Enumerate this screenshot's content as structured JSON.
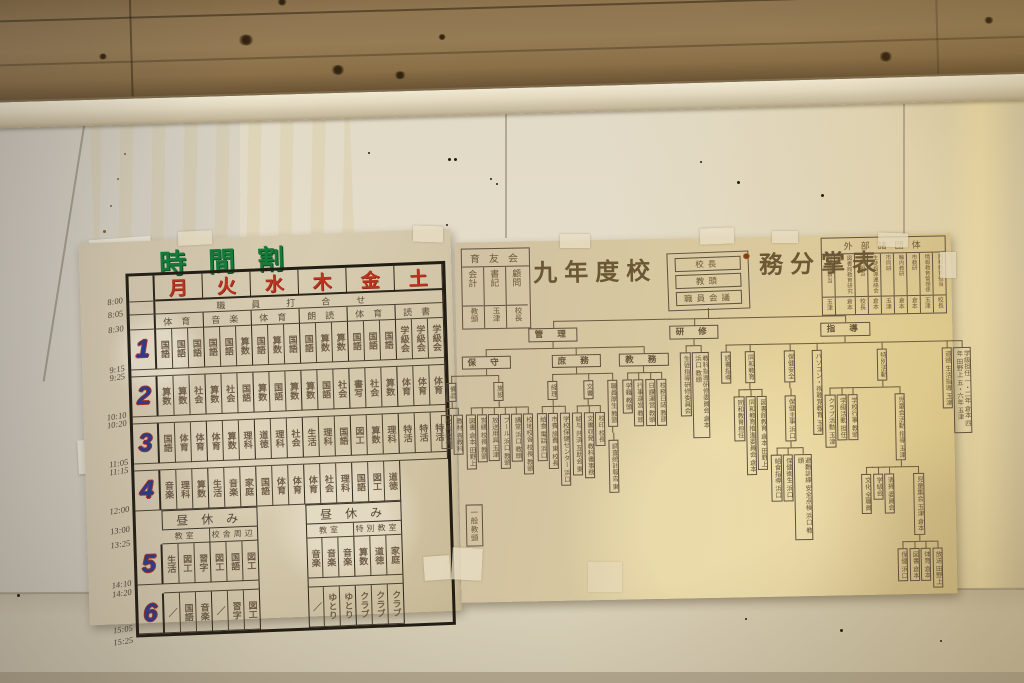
{
  "colors": {
    "title_green": "#157a3a",
    "day_red": "#b8341f",
    "period_blue": "#2b3a8f",
    "ink_brown": "#6b5838",
    "paper_left": "#d2c5a6",
    "paper_right": "#d8c89f",
    "wall_cream": "#e0d9c6",
    "wood_brown": "#8a6f48"
  },
  "timetable": {
    "title": "時間割",
    "days": [
      "月",
      "火",
      "水",
      "木",
      "金",
      "土"
    ],
    "staff_meeting": "職員打合せ",
    "morning_activities": [
      "体育",
      "音楽",
      "体育",
      "朗読",
      "体育",
      "読書"
    ],
    "period_labels": [
      "1",
      "2",
      "3",
      "4",
      "5",
      "6"
    ],
    "times": [
      "8:00",
      "8:05",
      "8:30",
      "9:15",
      "9:25",
      "10:10",
      "10:20",
      "11:05",
      "11:15",
      "12:00",
      "13:00",
      "13:25",
      "14:10",
      "14:20",
      "15:05",
      "15:25"
    ],
    "lunch": "昼休み",
    "locations": [
      "教室",
      "校舎周辺",
      "教室",
      "特別教室"
    ],
    "periods": [
      [
        "国語",
        "国語",
        "国語",
        "国語",
        "国語",
        "算数",
        "国語",
        "算数",
        "国語",
        "国語",
        "算数",
        "算数",
        "国語",
        "国語",
        "国語",
        "学級会",
        "学級会",
        "学級会"
      ],
      [
        "算数",
        "算数",
        "社会",
        "算数",
        "社会",
        "国語",
        "算数",
        "国語",
        "算数",
        "算数",
        "国語",
        "社会",
        "書写",
        "社会",
        "算数",
        "体育",
        "体育",
        "体育"
      ],
      [
        "国語",
        "体育",
        "体育",
        "体育",
        "算数",
        "理科",
        "道徳",
        "理科",
        "社会",
        "生活",
        "理科",
        "国語",
        "図工",
        "算数",
        "理科",
        "特活",
        "特活",
        "特活"
      ],
      [
        "音楽",
        "理科",
        "算数",
        "生活",
        "音楽",
        "家庭",
        "国語",
        "体育",
        "体育",
        "体育",
        "社会",
        "理科",
        "国語",
        "図工",
        "道徳",
        null,
        null,
        null
      ],
      [
        "生活",
        "図工",
        "習字",
        "図工",
        "国語",
        "図工",
        null,
        null,
        null,
        "音楽",
        "音楽",
        "音楽",
        "算数",
        "道徳",
        "家庭",
        null,
        null,
        null
      ],
      [
        "／",
        "国語",
        "音楽",
        "／",
        "習字",
        "図工",
        null,
        null,
        null,
        "／",
        "ゆとり",
        "ゆとり",
        "クラブ",
        "クラブ",
        "クラブ",
        null,
        null,
        null
      ]
    ]
  },
  "orgchart": {
    "title_left": "九年度校",
    "title_right": "務分掌表",
    "root": [
      "校長",
      "教頭",
      "職員会議"
    ],
    "general_staff": "一般教頭",
    "pta": {
      "header": "育友会",
      "cols": [
        {
          "role": "会計",
          "name": "教頭"
        },
        {
          "role": "書記",
          "name": "玉津"
        },
        {
          "role": "顧問",
          "name": "校長"
        }
      ]
    },
    "external": {
      "header": "外部諸団体",
      "cols": [
        {
          "role": "児童会担当",
          "name": "玉津"
        },
        {
          "role": "図書館教育研究会",
          "name": "倉本"
        },
        {
          "role": "ALT担当",
          "name": "校長"
        },
        {
          "role": "生徒指導連絡会",
          "name": "倉本"
        },
        {
          "role": "市同研",
          "name": "玉津"
        },
        {
          "role": "輪内教研",
          "name": "倉本"
        },
        {
          "role": "市教研",
          "name": "倉本"
        },
        {
          "role": "情報教育管理係",
          "name": "玉津"
        },
        {
          "role": "同和教育担当",
          "name": "校長"
        }
      ]
    },
    "tree": [
      {
        "t": "管 理",
        "h": 1,
        "k": [
          {
            "t": "保 守",
            "h": 1,
            "k": [
              {
                "t": "備品",
                "k": [
                  {
                    "t": "校具 校長"
                  },
                  {
                    "t": "教材 各教科"
                  }
                ]
              },
              {
                "t": "施設",
                "k": [
                  {
                    "t": "図書 倉本 田野上"
                  },
                  {
                    "t": "営繕 校長 教頭"
                  },
                  {
                    "t": "放送用具 玉津"
                  },
                  {
                    "t": "プール 浜口 教頭"
                  },
                  {
                    "t": "講堂 浜口 教頭"
                  },
                  {
                    "t": "校地校舎 校長 教頭"
                  }
                ]
              }
            ]
          },
          {
            "t": "庶 務",
            "h": 1,
            "k": [
              {
                "t": "経理",
                "k": [
                  {
                    "t": "給食 電話 浜口"
                  },
                  {
                    "t": "市費 旅費 東 校長"
                  },
                  {
                    "t": "学校保健センター 浜口"
                  }
                ]
              },
              {
                "t": "文書",
                "k": [
                  {
                    "t": "給与 共済 互助会 東"
                  },
                  {
                    "t": "文書収発 教科書事務"
                  },
                  {
                    "t": "校印 校長"
                  }
                ]
              },
              {
                "t": "職員厚生 教頭",
                "k": [
                  {
                    "t": "調査統計報告 東"
                  }
                ]
              }
            ]
          },
          {
            "t": "教 務",
            "h": 1,
            "k": [
              {
                "t": "学籍 教頭"
              },
              {
                "t": "行事運営 教頭"
              },
              {
                "t": "日課運営 教頭"
              },
              {
                "t": "校務日誌 教頭"
              }
            ]
          }
        ]
      },
      {
        "t": "研 修",
        "h": 1,
        "k": [
          {
            "t": "生徒指導研修委員会"
          },
          {
            "t": "教科指導研修委員会 倉本 浜口 教頭"
          }
        ]
      },
      {
        "t": "指 導",
        "h": 1,
        "k": [
          {
            "t": "読書指導"
          },
          {
            "t": "同和教育",
            "k": [
              {
                "t": "同和教育担任"
              },
              {
                "t": "同和教育推進委員会 倉本"
              },
              {
                "t": "図書館教育 倉本 田野上"
              }
            ]
          },
          {
            "t": "保健安全",
            "k": [
              {
                "t": "保健主事 浜口",
                "k": [
                  {
                    "t": "給食指導 浜口"
                  },
                  {
                    "t": "保健衛生 浜口"
                  },
                  {
                    "t": "避難訓練 安全点検 浜口 教頭"
                  }
                ]
              }
            ]
          },
          {
            "t": "パソコン・視聴覚教育 玉津"
          },
          {
            "t": "特別活動",
            "k": [
              {
                "t": "クラブ活動 玉津"
              },
              {
                "t": "学級活動 担任"
              },
              {
                "t": "学校行事 教頭"
              },
              {
                "t": "児童会活動 指導 玉津",
                "k": [
                  {
                    "t": "文化 全職員"
                  },
                  {
                    "t": "学級会"
                  },
                  {
                    "t": "清掃 委員会"
                  },
                  {
                    "t": "児童集会 玉津 倉本",
                    "k": [
                      {
                        "t": "保健 浜口"
                      },
                      {
                        "t": "図書 倉本"
                      },
                      {
                        "t": "体育 倉本"
                      },
                      {
                        "t": "放送 田野上"
                      }
                    ]
                  }
                ]
              }
            ]
          },
          {
            "t": "道徳 生活指導 玉津"
          },
          {
            "t": "学級担任 一・二年 倉本 四年 田野上 五・六年 玉津"
          }
        ]
      }
    ]
  }
}
